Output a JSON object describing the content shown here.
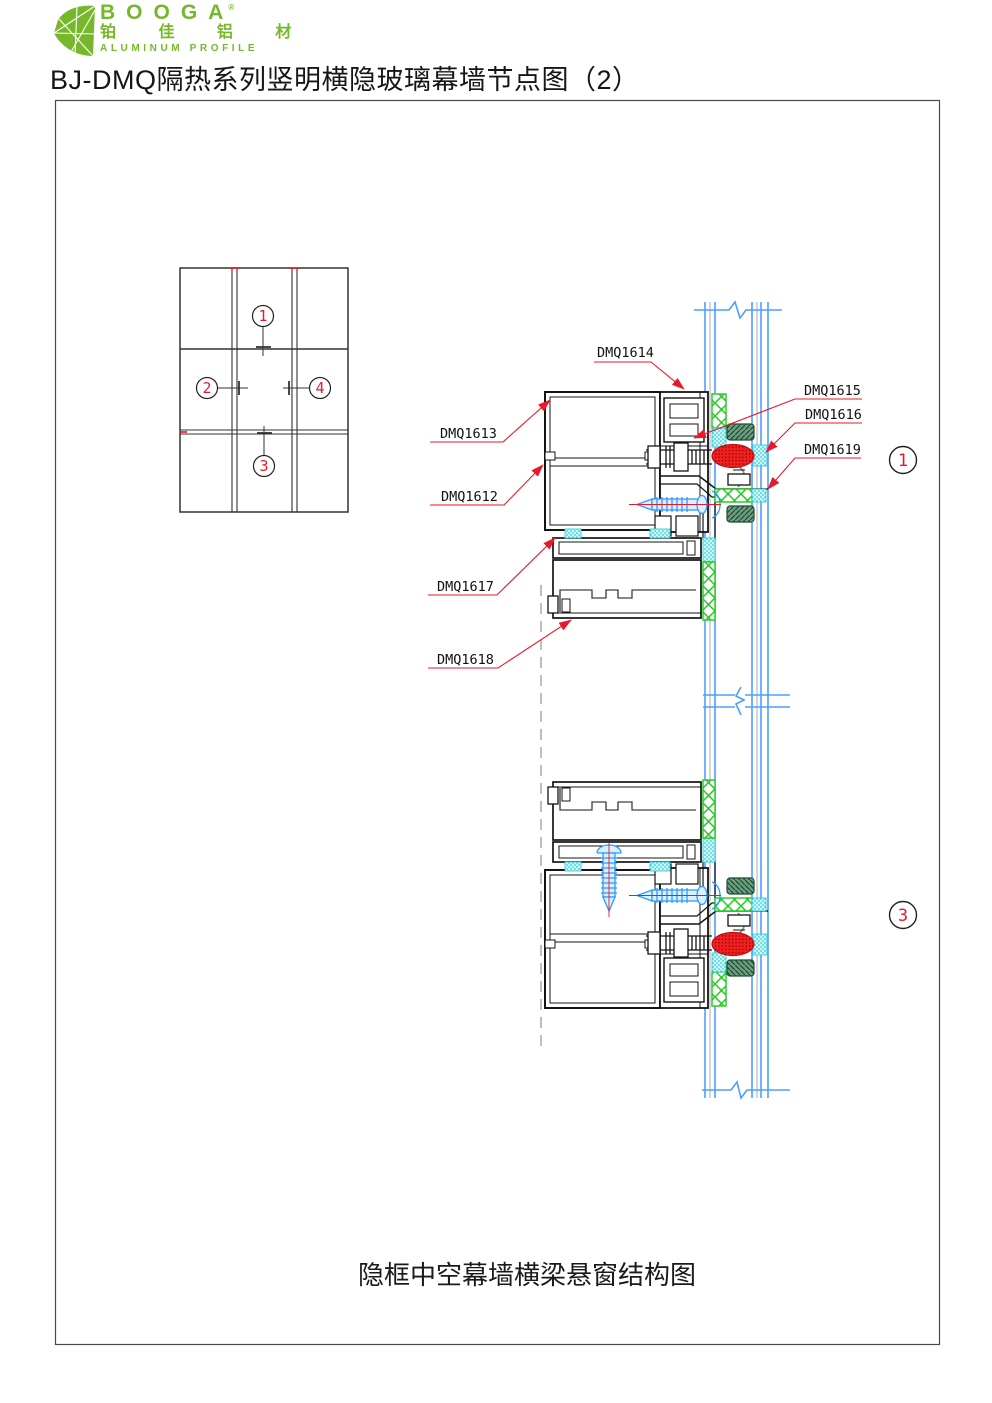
{
  "header": {
    "logo": {
      "brand": "BOOGA",
      "registered": "®",
      "brand_cn": "铂 佳 铝 材",
      "tagline": "ALUMINUM PROFILE",
      "brand_green": "#76b82a"
    },
    "title": "BJ-DMQ隔热系列竖明横隐玻璃幕墙节点图（2）"
  },
  "sheet": {
    "caption": "隐框中空幕墙横梁悬窗结构图",
    "elevation_callouts": [
      "1",
      "2",
      "4",
      "3"
    ],
    "detail_callouts": [
      "1",
      "3"
    ],
    "part_labels": [
      "DMQ1614",
      "DMQ1613",
      "DMQ1612",
      "DMQ1617",
      "DMQ1618",
      "DMQ1615",
      "DMQ1616",
      "DMQ1619"
    ],
    "colors": {
      "leader_red": "#e8192c",
      "glass_blue": "#4d9fff",
      "screw_blue": "#2f9bff",
      "sealant_cyan": "#bff2f4",
      "structural_silicone_green": "#1ecb1e",
      "gasket_red": "#ee2222",
      "setting_block_green": "#33664d"
    }
  }
}
